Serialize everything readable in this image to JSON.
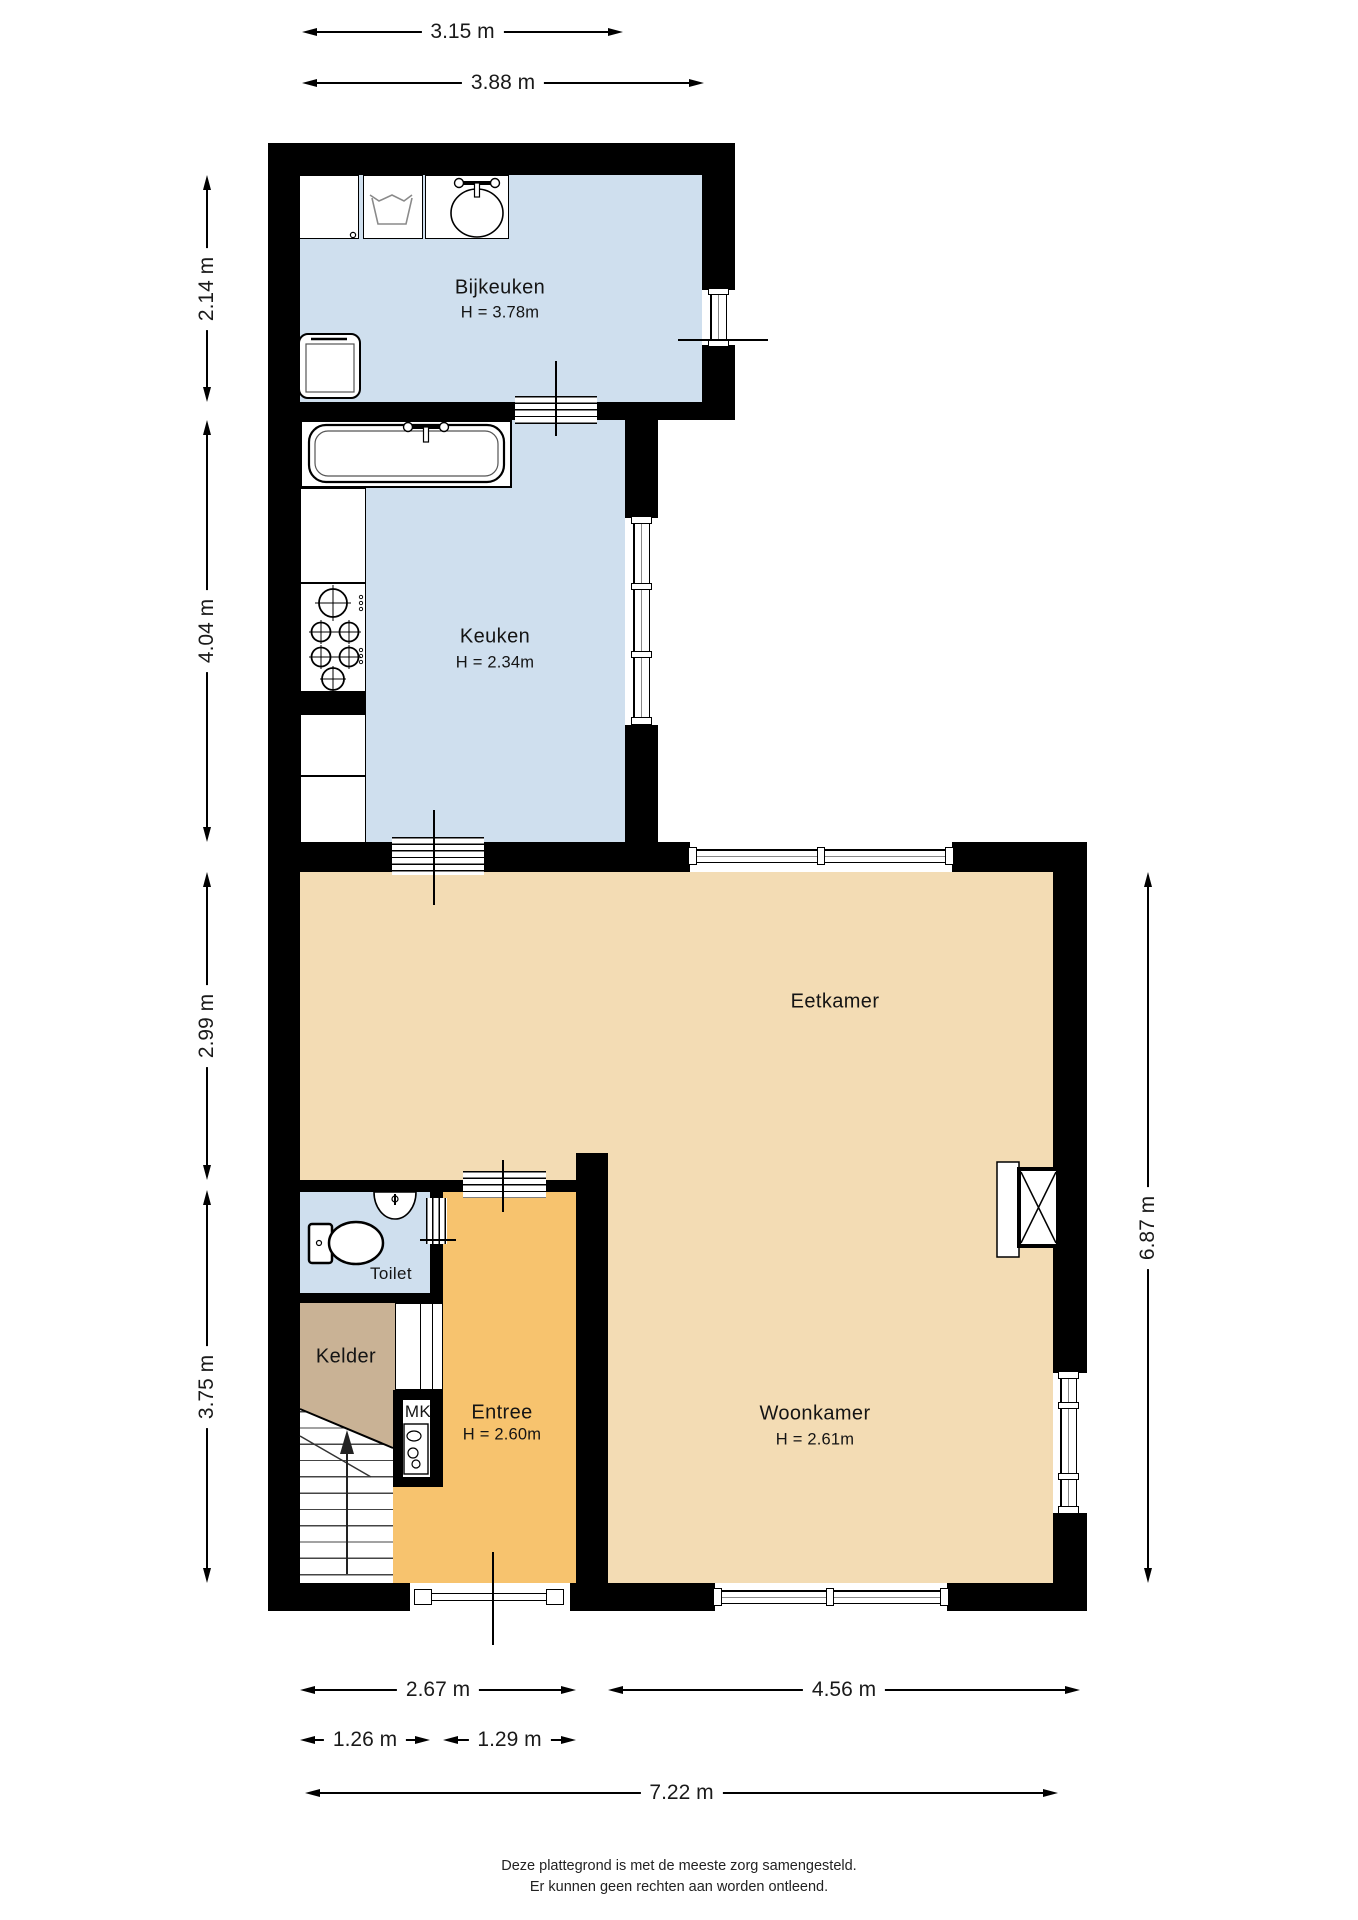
{
  "page": {
    "footer_line1": "Deze plattegrond is met de meeste zorg samengesteld.",
    "footer_line2": "Er kunnen geen rechten aan worden ontleend."
  },
  "rooms": {
    "bijkeuken": {
      "name": "Bijkeuken",
      "height": "H = 3.78m"
    },
    "keuken": {
      "name": "Keuken",
      "height": "H = 2.34m"
    },
    "eetkamer": {
      "name": "Eetkamer"
    },
    "toilet": {
      "name": "Toilet"
    },
    "kelder": {
      "name": "Kelder"
    },
    "meterkast": {
      "name": "MK"
    },
    "entree": {
      "name": "Entree",
      "height": "H = 2.60m"
    },
    "woonkamer": {
      "name": "Woonkamer",
      "height": "H = 2.61m"
    }
  },
  "dimensions": {
    "top_inner_width": "3.15 m",
    "top_outer_width": "3.88 m",
    "left_bijkeuken_depth": "2.14 m",
    "left_keuken_depth": "4.04 m",
    "left_eetkamer_depth": "2.99 m",
    "left_lower_depth": "3.75 m",
    "right_total_depth": "6.87 m",
    "bottom_left_width": "2.67 m",
    "bottom_right_width": "4.56 m",
    "bottom_stairs_width": "1.26 m",
    "bottom_entree_width": "1.29 m",
    "bottom_total_width": "7.22 m"
  },
  "colors": {
    "wall": "#000000",
    "kitchen_floor": "#cfdfee",
    "living_floor": "#f3dcb4",
    "entree_floor": "#f7c36e",
    "kelder_floor": "#c9b295",
    "exterior": "#ffffff"
  }
}
